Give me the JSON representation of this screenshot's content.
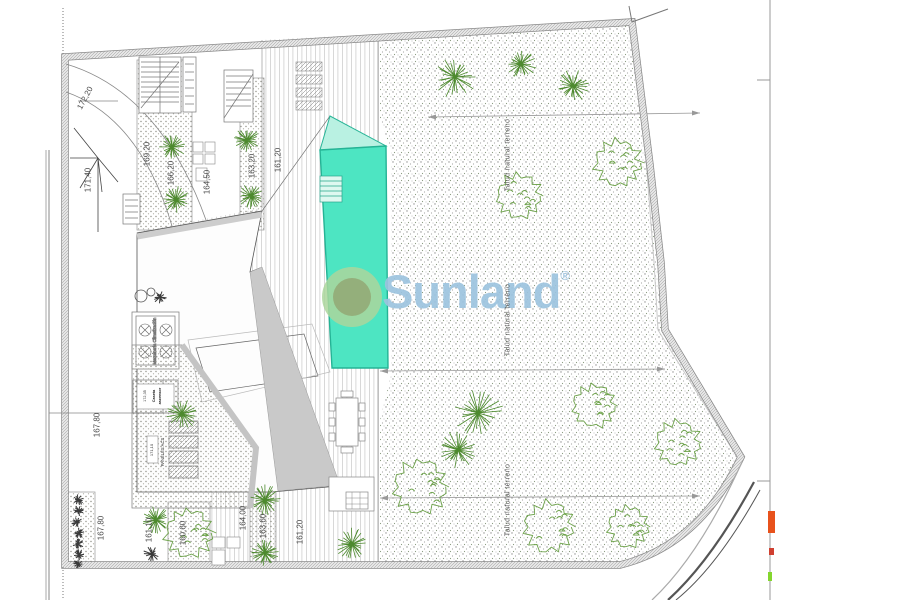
{
  "watermark": {
    "text": "Sunland",
    "registered_mark": "®",
    "text_color": "#9cc3de",
    "logo_outer_color": "#abd69c",
    "logo_inner_color": "#93ab77"
  },
  "colors": {
    "pool": "#4de5c2",
    "pool_shallow": "#b9f1e2",
    "pool_edge": "#2ab598",
    "palm_green": "#4d8a2e",
    "bush_green": "#6da24a",
    "gray_wedge": "#c9c9c9",
    "accent_orange": "#e8521c",
    "accent_red": "#d04030",
    "accent_green": "#84d62e"
  },
  "equipment": {
    "climatizacion_label": "Maquinaria Climatización",
    "solar_panels_label": "PANELES ACS",
    "solar_panels_cota": "171,10",
    "caseta_cota": "172,35",
    "caseta_line1": "Caseta",
    "caseta_line2": "ascensor"
  },
  "labels": [
    {
      "text": "172,20",
      "x": 85,
      "y": 98,
      "rot": -62,
      "kind": "cota"
    },
    {
      "text": "171,40",
      "x": 88,
      "y": 180,
      "rot": -90,
      "kind": "cota"
    },
    {
      "text": "169,20",
      "x": 147,
      "y": 154,
      "rot": -90,
      "kind": "cota"
    },
    {
      "text": "166,20",
      "x": 171,
      "y": 173,
      "rot": -90,
      "kind": "cota"
    },
    {
      "text": "164,50",
      "x": 207,
      "y": 182,
      "rot": -90,
      "kind": "cota"
    },
    {
      "text": "163,20",
      "x": 252,
      "y": 166,
      "rot": -90,
      "kind": "cota"
    },
    {
      "text": "161,20",
      "x": 278,
      "y": 160,
      "rot": -90,
      "kind": "cota"
    },
    {
      "text": "167,80",
      "x": 97,
      "y": 425,
      "rot": -90,
      "kind": "cota"
    },
    {
      "text": "167,80",
      "x": 101,
      "y": 528,
      "rot": -90,
      "kind": "cota"
    },
    {
      "text": "161,10",
      "x": 149,
      "y": 530,
      "rot": -90,
      "kind": "cota"
    },
    {
      "text": "160,60",
      "x": 183,
      "y": 533,
      "rot": -90,
      "kind": "cota"
    },
    {
      "text": "164,00",
      "x": 243,
      "y": 518,
      "rot": -90,
      "kind": "cota"
    },
    {
      "text": "163,60",
      "x": 263,
      "y": 526,
      "rot": -90,
      "kind": "cota"
    },
    {
      "text": "161,20",
      "x": 300,
      "y": 532,
      "rot": -90,
      "kind": "cota"
    },
    {
      "text": "Talud natural terreno",
      "x": 508,
      "y": 155,
      "rot": -90,
      "kind": "talud"
    },
    {
      "text": "Talud natural terreno",
      "x": 508,
      "y": 320,
      "rot": -90,
      "kind": "talud"
    },
    {
      "text": "Talud natural terreno",
      "x": 508,
      "y": 500,
      "rot": -90,
      "kind": "talud"
    }
  ],
  "plants": [
    {
      "type": "palm",
      "x": 172,
      "y": 147,
      "r": 14
    },
    {
      "type": "palm",
      "x": 176,
      "y": 200,
      "r": 14
    },
    {
      "type": "palm",
      "x": 247,
      "y": 140,
      "r": 13
    },
    {
      "type": "palm",
      "x": 251,
      "y": 196,
      "r": 13
    },
    {
      "type": "palm",
      "x": 455,
      "y": 77,
      "r": 22
    },
    {
      "type": "palm",
      "x": 521,
      "y": 64,
      "r": 16
    },
    {
      "type": "palm",
      "x": 573,
      "y": 86,
      "r": 18
    },
    {
      "type": "palm",
      "x": 478,
      "y": 413,
      "r": 26
    },
    {
      "type": "palm",
      "x": 458,
      "y": 450,
      "r": 20
    },
    {
      "type": "palm",
      "x": 352,
      "y": 544,
      "r": 17
    },
    {
      "type": "palm",
      "x": 182,
      "y": 414,
      "r": 16
    },
    {
      "type": "palm",
      "x": 265,
      "y": 500,
      "r": 16
    },
    {
      "type": "palm",
      "x": 265,
      "y": 553,
      "r": 14
    },
    {
      "type": "palm",
      "x": 156,
      "y": 520,
      "r": 14
    },
    {
      "type": "bush",
      "x": 618,
      "y": 163,
      "r": 25
    },
    {
      "type": "bush",
      "x": 519,
      "y": 196,
      "r": 24
    },
    {
      "type": "bush",
      "x": 594,
      "y": 406,
      "r": 23
    },
    {
      "type": "bush",
      "x": 678,
      "y": 443,
      "r": 24
    },
    {
      "type": "bush",
      "x": 420,
      "y": 487,
      "r": 29
    },
    {
      "type": "bush",
      "x": 549,
      "y": 527,
      "r": 27
    },
    {
      "type": "bush",
      "x": 628,
      "y": 527,
      "r": 22
    },
    {
      "type": "bush",
      "x": 189,
      "y": 533,
      "r": 26
    },
    {
      "type": "shrub",
      "x": 152,
      "y": 554,
      "r": 9
    },
    {
      "type": "shrub",
      "x": 160,
      "y": 297,
      "r": 7
    },
    {
      "type": "shrub",
      "x": 78,
      "y": 500,
      "r": 6
    },
    {
      "type": "shrub",
      "x": 79,
      "y": 511,
      "r": 6
    },
    {
      "type": "shrub",
      "x": 77,
      "y": 522,
      "r": 6
    },
    {
      "type": "shrub",
      "x": 79,
      "y": 533,
      "r": 6
    },
    {
      "type": "shrub",
      "x": 78,
      "y": 544,
      "r": 6
    },
    {
      "type": "shrub",
      "x": 79,
      "y": 555,
      "r": 6
    },
    {
      "type": "shrub",
      "x": 78,
      "y": 564,
      "r": 5
    }
  ],
  "edge_marks": [
    {
      "color": "#e8521c",
      "x": 768,
      "y": 511,
      "w": 7,
      "h": 22
    },
    {
      "color": "#d04030",
      "x": 769,
      "y": 548,
      "w": 5,
      "h": 7
    },
    {
      "color": "#84d62e",
      "x": 768,
      "y": 572,
      "w": 4,
      "h": 9
    }
  ]
}
